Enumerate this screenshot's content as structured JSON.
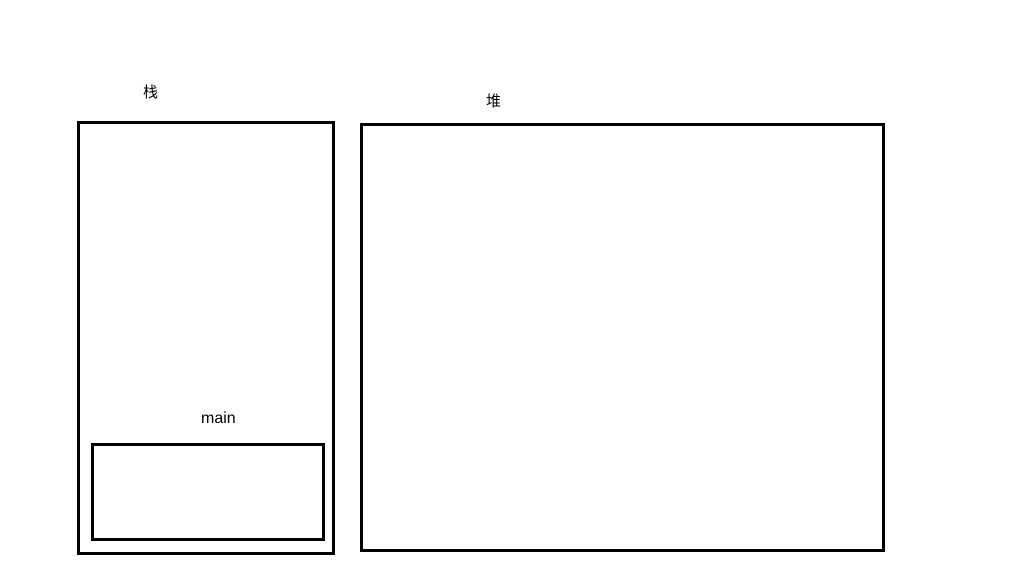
{
  "diagram": {
    "stack": {
      "label": "栈",
      "main_frame": {
        "label": "main"
      }
    },
    "heap": {
      "label": "堆"
    },
    "colors": {
      "border": "#000000",
      "text": "#000000",
      "background": "#ffffff"
    }
  }
}
